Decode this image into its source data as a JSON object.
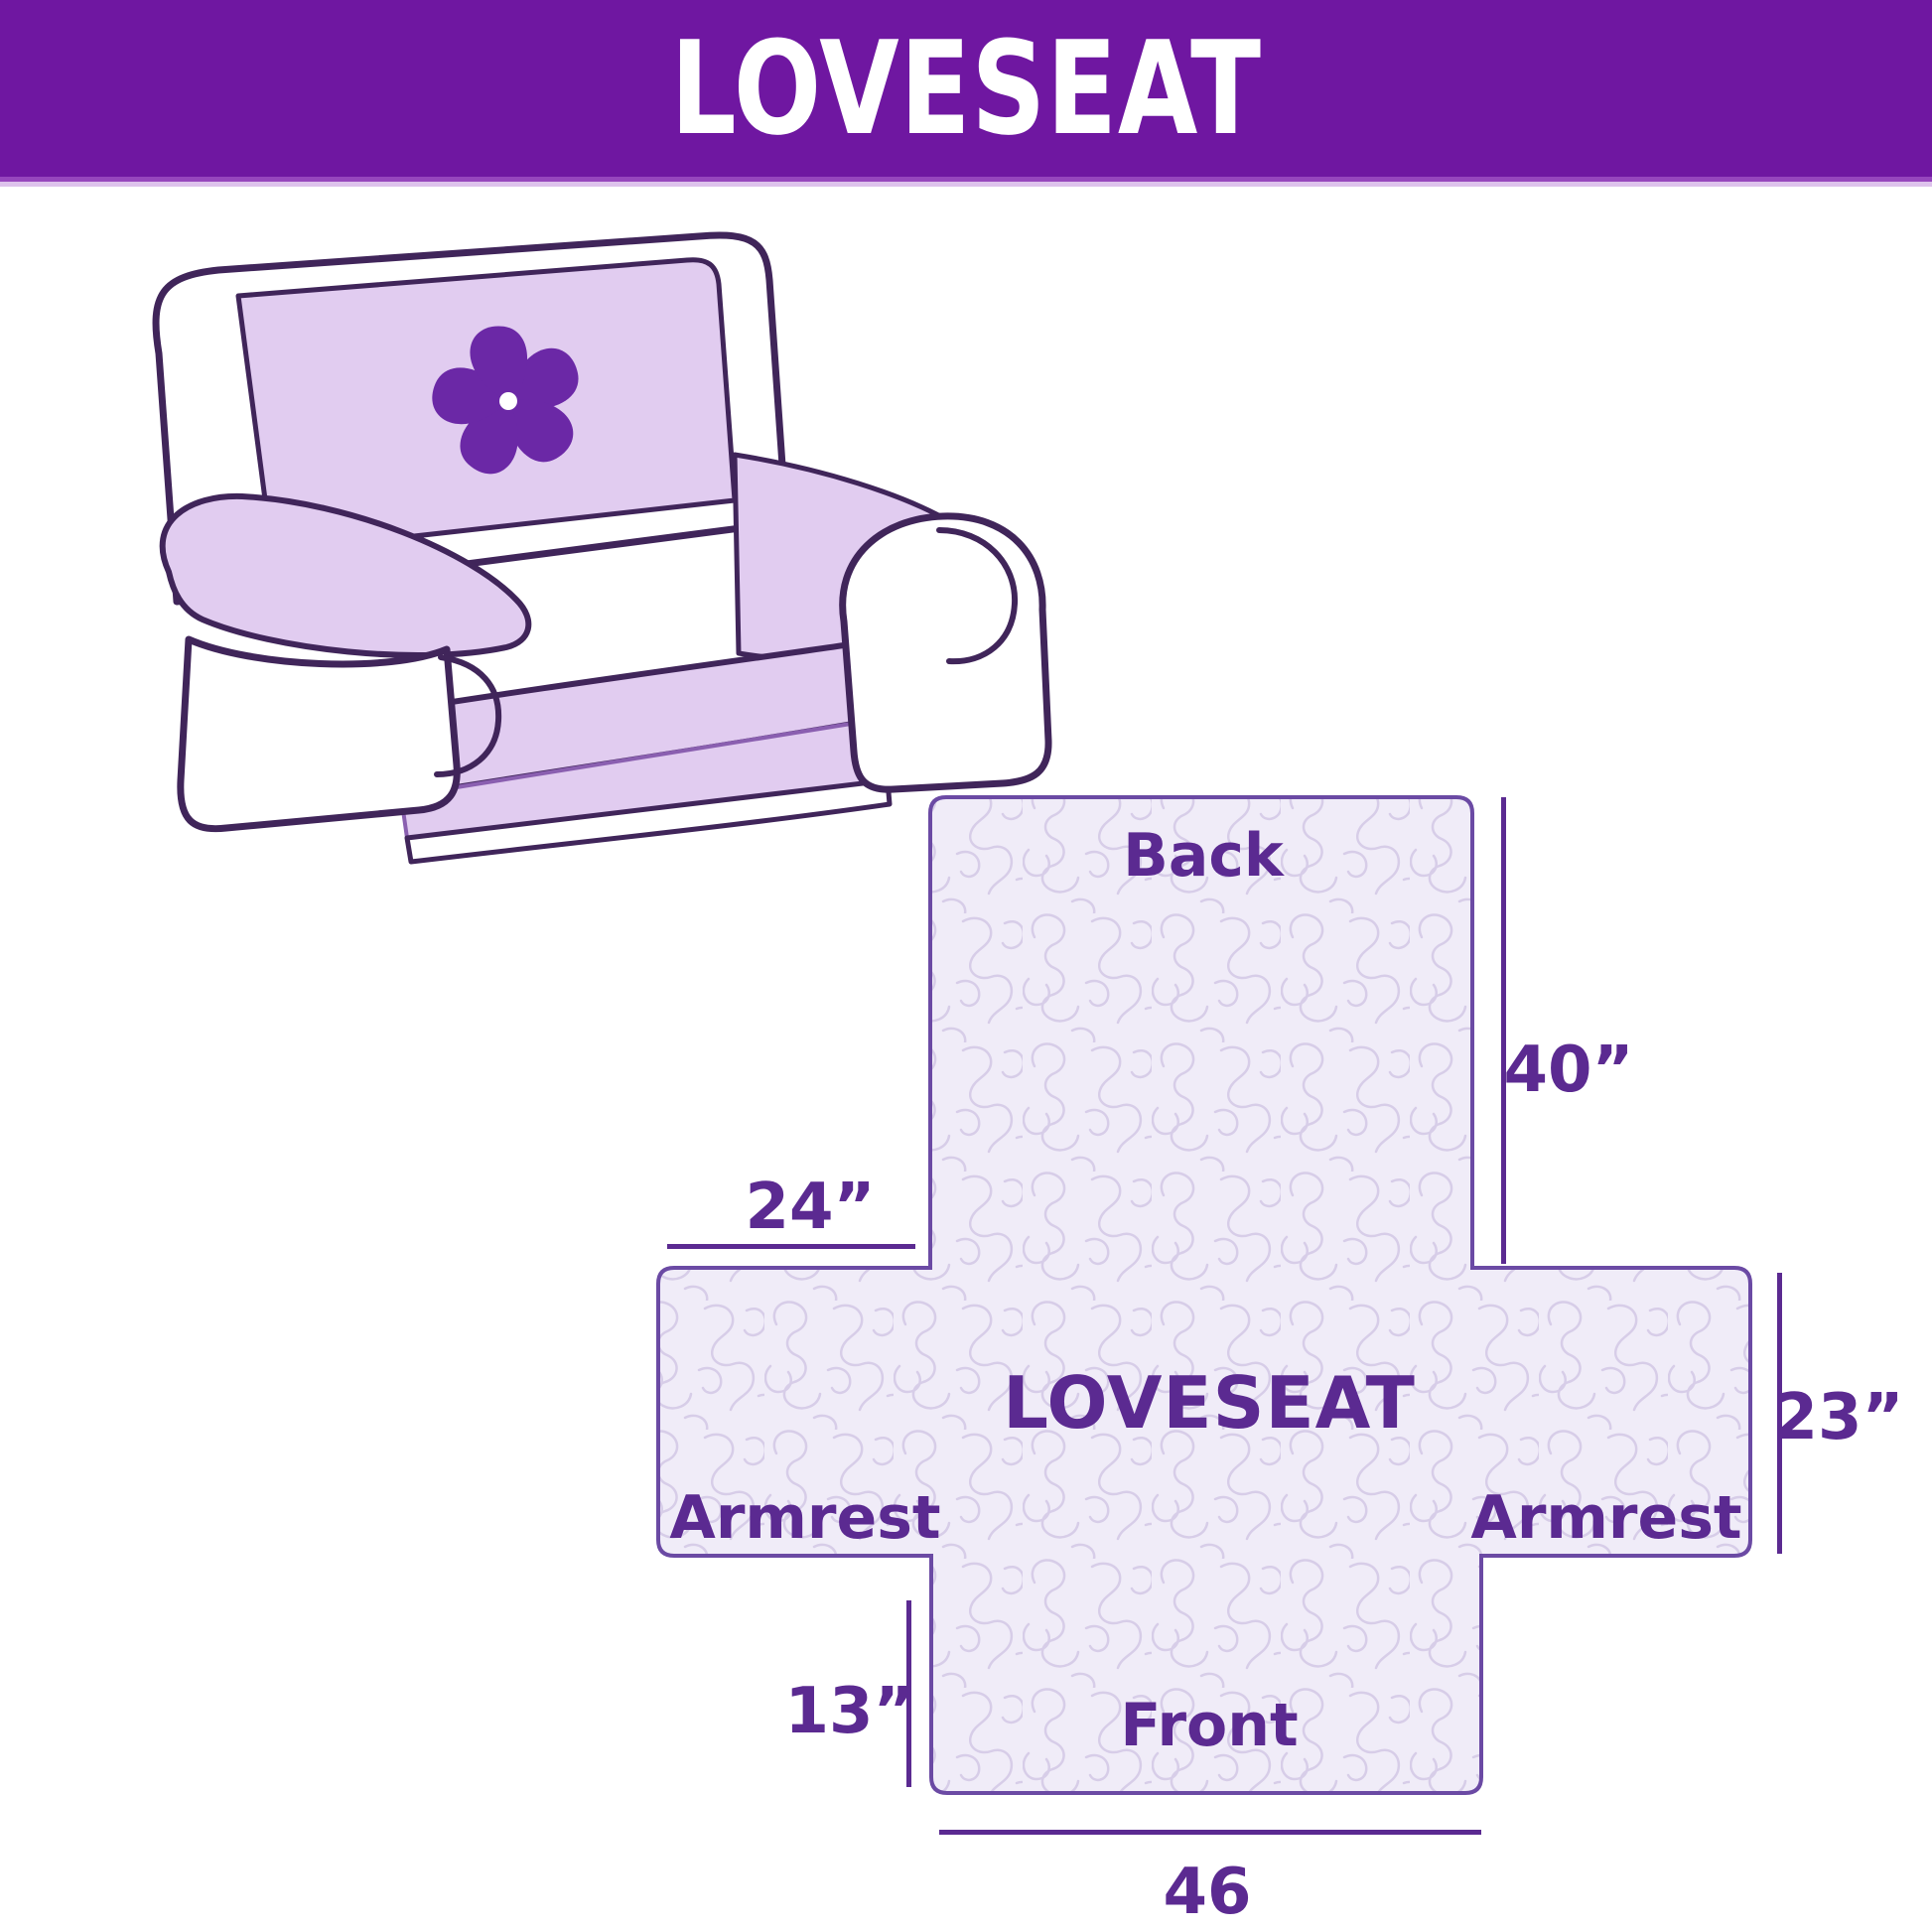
{
  "header": {
    "title": "LOVESEAT",
    "background_color": "#6f17a1",
    "stripe_color_1": "#9646bd",
    "stripe_color_2": "#ddc2ec",
    "text_color": "#ffffff"
  },
  "illustration": {
    "description": "loveseat sofa with lavender protective cover",
    "outline_color": "#40255a",
    "cover_color": "#e1ccf0",
    "body_color": "#ffffff",
    "logo_icon": "pinwheel-flower-icon",
    "logo_color": "#6b28a6"
  },
  "diagram": {
    "center_label": "LOVESEAT",
    "labels": {
      "back": "Back",
      "front": "Front",
      "armrest_left": "Armrest",
      "armrest_right": "Armrest"
    },
    "dimensions": {
      "back_height": "40”",
      "armrest_width": "24”",
      "armrest_height": "23”",
      "front_height": "13”",
      "front_width": "46"
    },
    "fill_color": "#f0ecf8",
    "pattern_color": "#d7cde8",
    "border_color": "#6b4aa4",
    "text_color": "#5b2a91"
  }
}
